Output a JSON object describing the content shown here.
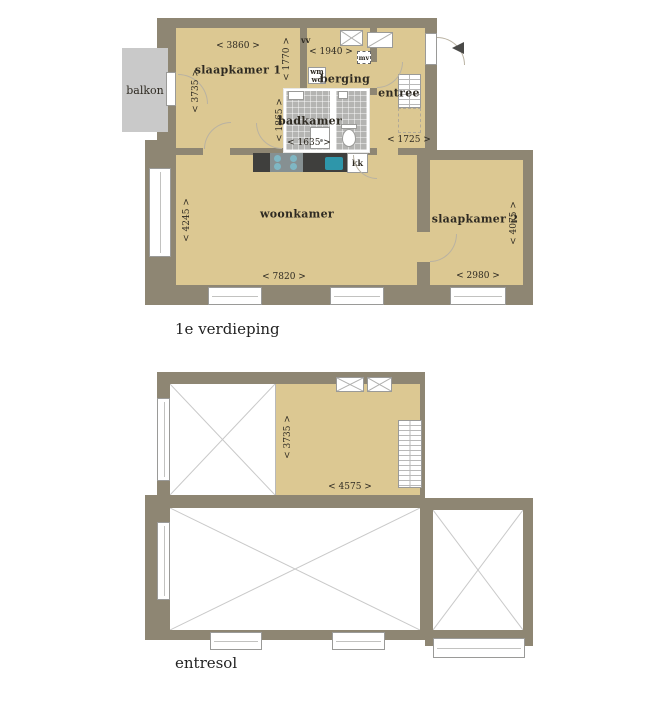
{
  "floor1": {
    "title": "1e verdieping",
    "balkon": "balkon",
    "slaapkamer1": "slaapkamer 1",
    "berging": "berging",
    "entree": "entree",
    "badkamer": "badkamer",
    "woonkamer": "woonkamer",
    "slaapkamer2": "slaapkamer 2",
    "vv": "vv",
    "mv": "mv",
    "wm": "wm",
    "wd": "wd",
    "kk": "kk",
    "dim_slaapkamer1_w": "< 3860 >",
    "dim_slaapkamer1_h": "< 1770 >",
    "dim_balkon_door": "< 3735 >",
    "dim_berging_w": "< 1940 >",
    "dim_badkamer_h": "< 1865 >",
    "dim_badkamer_w": "< 1635 >",
    "dim_entree_w": "< 1725 >",
    "dim_woonkamer_h": "< 4245 >",
    "dim_woonkamer_w": "< 7820 >",
    "dim_slaapkamer2_h": "< 4075 >",
    "dim_slaapkamer2_w": "< 2980 >"
  },
  "floor2": {
    "title": "entresol",
    "dim_room_h": "< 3735 >",
    "dim_room_w": "< 4575 >"
  },
  "colors": {
    "wall": "#8e8673",
    "room_fill": "#dcc892",
    "balcony": "#c9c9c9",
    "bathroom_tile": "#b4b4b2",
    "kitchen_counter": "#3f3f3d",
    "fixture_teal": "#2e96aa",
    "void_cross_line": "#c9c9c9"
  }
}
